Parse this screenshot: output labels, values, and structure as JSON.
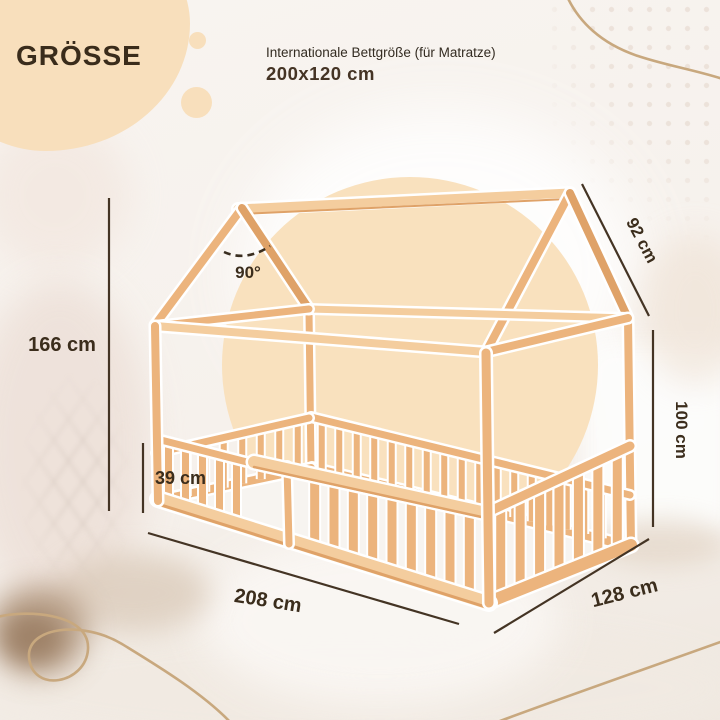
{
  "header": {
    "badge": "GRÖSSE",
    "subtitle": "Internationale Bettgröße (für Matratze)",
    "mattress_size": "200x120 cm"
  },
  "dimensions": {
    "total_height": "166 cm",
    "fence_height": "39 cm",
    "roof_slope_depth": "92 cm",
    "side_height": "100 cm",
    "length": "208 cm",
    "width": "128 cm",
    "roof_angle": "90°"
  },
  "colors": {
    "wood": "#ECB47D",
    "wood_light": "#F4CD9E",
    "wood_dark": "#DFA268",
    "accent_peach": "#F8DFBC",
    "text_dark": "#3B2D1C",
    "dimension_line": "#443424",
    "squiggle": "#C8A87E"
  }
}
